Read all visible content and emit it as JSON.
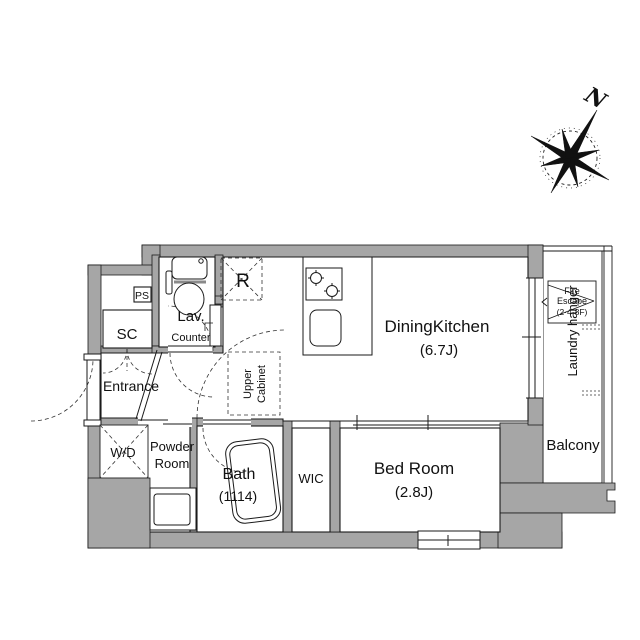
{
  "compass": {
    "north_label": "N"
  },
  "rooms": {
    "dining_kitchen": {
      "name": "DiningKitchen",
      "size": "(6.7J)"
    },
    "bed_room": {
      "name": "Bed Room",
      "size": "(2.8J)"
    },
    "bath": {
      "name": "Bath",
      "size": "(1114)"
    },
    "wic": {
      "name": "WIC"
    },
    "entrance": {
      "name": "Entrance"
    },
    "lavatory": {
      "name": "Lav."
    },
    "counter": {
      "name": "Counter"
    },
    "powder_room": {
      "line1": "Powder",
      "line2": "Room"
    },
    "sc": {
      "name": "SC"
    },
    "ps": {
      "name": "PS"
    },
    "wd": {
      "name": "W/D"
    },
    "refrigerator": {
      "name": "R"
    },
    "upper_cabinet": {
      "line1": "Upper",
      "line2": "Cabinet"
    },
    "balcony": {
      "name": "Balcony"
    },
    "fire_escape": {
      "line1": "Fire",
      "line2": "Escape",
      "line3": "(2·4·8F)"
    },
    "laundry_hanger": {
      "name": "Laundry hanger"
    }
  },
  "colors": {
    "wall": "#a6a6a6",
    "line": "#1a1a1a"
  }
}
